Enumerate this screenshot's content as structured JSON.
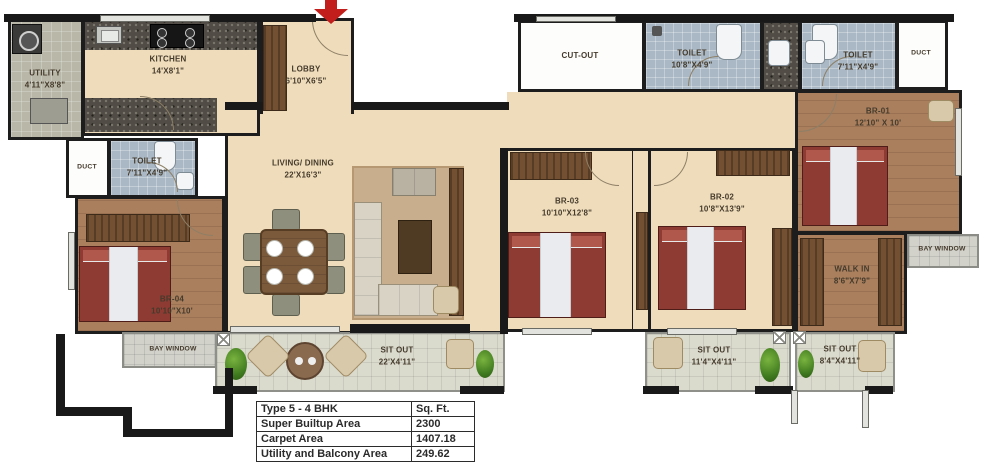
{
  "plan": {
    "rooms": {
      "utility": {
        "name": "UTILITY",
        "dim": "4'11\"X8'8\""
      },
      "kitchen": {
        "name": "KITCHEN",
        "dim": "14'X8'1\""
      },
      "lobby": {
        "name": "LOBBY",
        "dim": "6'10\"X6'5\""
      },
      "living": {
        "name": "LIVING/ DINING",
        "dim": "22'X16'3\""
      },
      "cutout": {
        "name": "CUT-OUT"
      },
      "toilet_top": {
        "name": "TOILET",
        "dim": "10'8\"X4'9\""
      },
      "toilet_right": {
        "name": "TOILET",
        "dim": "7'11\"X4'9\""
      },
      "duct_right": {
        "name": "DUCT"
      },
      "br01": {
        "name": "BR-01",
        "dim": "12'10\" X 10'"
      },
      "bay_right": {
        "name": "BAY WINDOW"
      },
      "walkin": {
        "name": "WALK IN",
        "dim": "8'6\"X7'9\""
      },
      "br03": {
        "name": "BR-03",
        "dim": "10'10\"X12'8\""
      },
      "br02": {
        "name": "BR-02",
        "dim": "10'8\"X13'9\""
      },
      "duct_left": {
        "name": "DUCT"
      },
      "toilet_left": {
        "name": "TOILET",
        "dim": "7'11\"X4'9\""
      },
      "br04": {
        "name": "BR-04",
        "dim": "10'10\"X10'"
      },
      "bay_left": {
        "name": "BAY WINDOW"
      },
      "sitout_main": {
        "name": "SIT OUT",
        "dim": "22'X4'11\""
      },
      "sitout_mid": {
        "name": "SIT OUT",
        "dim": "11'4\"X4'11\""
      },
      "sitout_right": {
        "name": "SIT OUT",
        "dim": "8'4\"X4'11\""
      }
    },
    "area_table": {
      "header": {
        "col1": "Type 5 - 4 BHK",
        "col2": "Sq. Ft."
      },
      "rows": [
        {
          "label": "Super Builtup Area",
          "value": "2300"
        },
        {
          "label": "Carpet Area",
          "value": "1407.18"
        },
        {
          "label": "Utility and Balcony Area",
          "value": "249.62"
        }
      ]
    },
    "colors": {
      "wall": "#1d1d1d",
      "floor_beige": "#efdcbb",
      "floor_wood": "#a97f5e",
      "toilet_tile": "#a9b8c4",
      "balcony_tile": "#dadacd",
      "bed_red": "#8e3b33",
      "entrance_arrow": "#c21f1c"
    }
  }
}
